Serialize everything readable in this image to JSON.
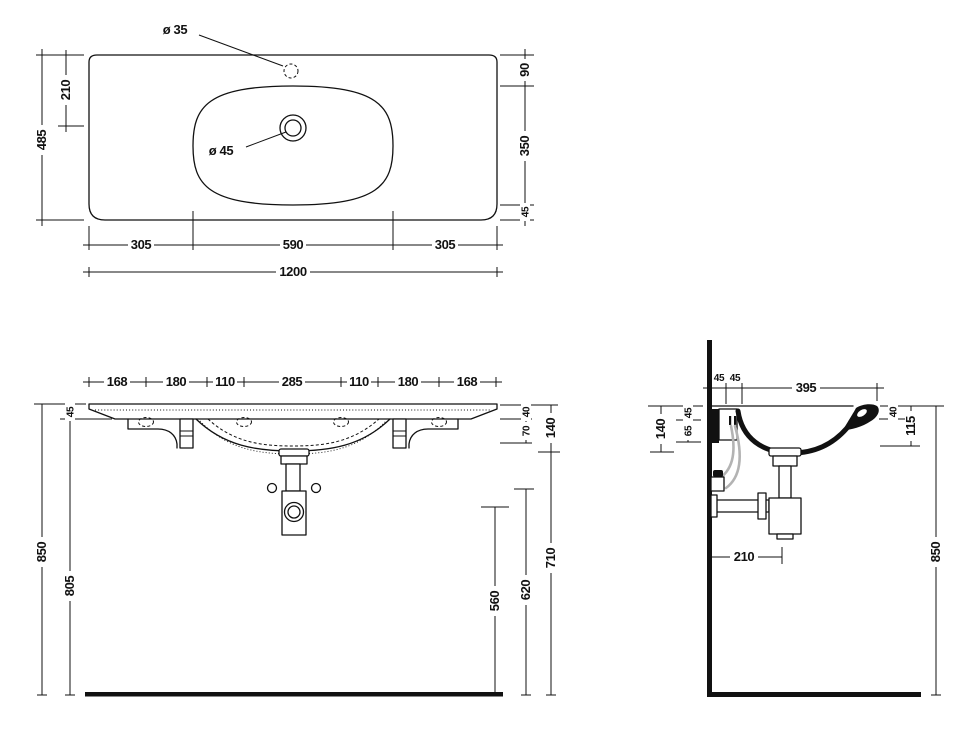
{
  "colors": {
    "line": "#111111",
    "hose": "#b3b3b3",
    "background": "#ffffff"
  },
  "views": {
    "top": {
      "faucet_hole_dia": "ø 35",
      "drain_dia": "ø 45",
      "depth_total": "485",
      "drain_from_back": "210",
      "back_to_bowl": "90",
      "bowl_depth": "350",
      "bowl_to_front": "45",
      "left_to_bowl": "305",
      "bowl_width": "590",
      "bowl_to_right": "305",
      "width_total": "1200"
    },
    "front": {
      "spacings": [
        "168",
        "180",
        "110",
        "285",
        "110",
        "180",
        "168"
      ],
      "slab_offset": "45",
      "edge_drop": "40",
      "apron_drop": "70",
      "basin_height": "140",
      "height_total": "850",
      "underside_height": "805",
      "trap_outlet_height": "560",
      "trap_top_height": "620",
      "clearance_height": "710"
    },
    "side": {
      "back_gap_1": "45",
      "back_gap_2": "45",
      "open_depth": "395",
      "rim_drop": "45",
      "bracket_drop": "65",
      "basin_height": "140",
      "front_edge_drop": "40",
      "front_height": "115",
      "height_total": "850",
      "trap_from_wall": "210"
    }
  }
}
